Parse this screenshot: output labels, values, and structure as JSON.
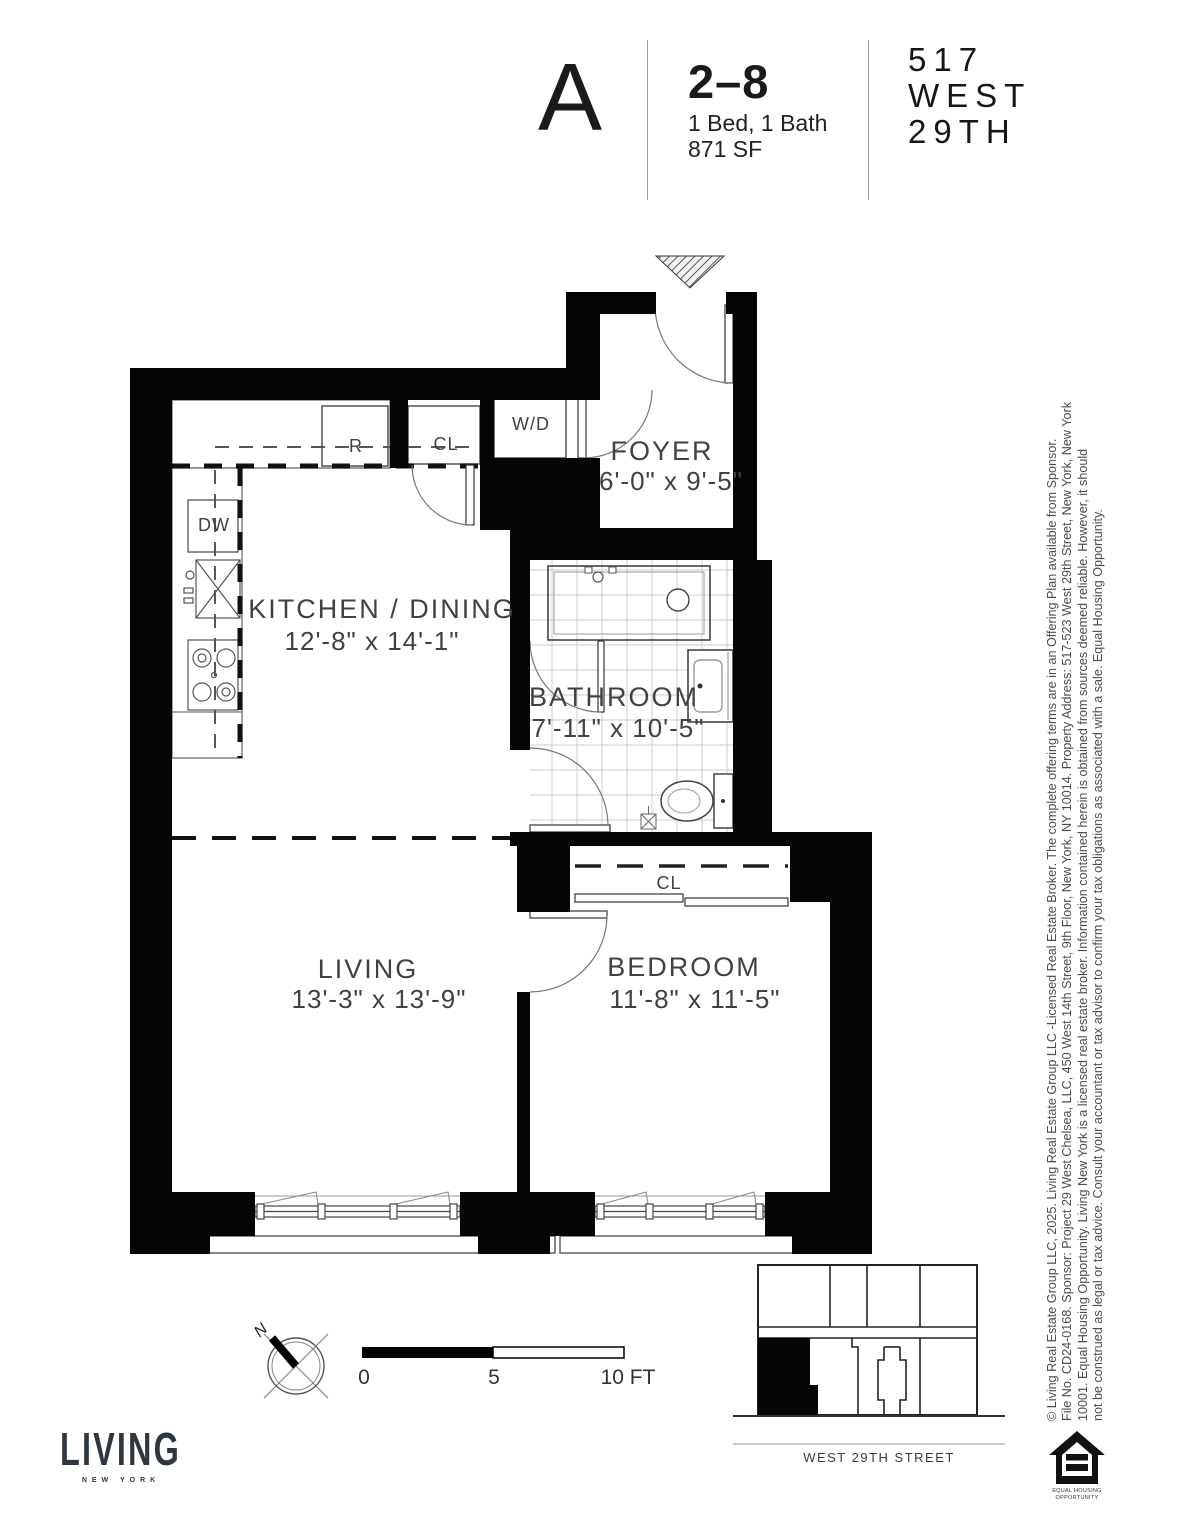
{
  "header": {
    "unit": "A",
    "floors": "2–8",
    "config": "1 Bed, 1 Bath",
    "area": "871 SF",
    "building": {
      "line1": "517",
      "line2": "WEST",
      "line3": "29TH"
    }
  },
  "rooms": {
    "foyer": {
      "name": "FOYER",
      "dims": "6'-0\" x 9'-5\""
    },
    "kitchen": {
      "name": "KITCHEN / DINING",
      "dims": "12'-8\" x 14'-1\""
    },
    "bathroom": {
      "name": "BATHROOM",
      "dims": "7'-11\" x 10'-5\""
    },
    "living": {
      "name": "LIVING",
      "dims": "13'-3\" x 13'-9\""
    },
    "bedroom": {
      "name": "BEDROOM",
      "dims": "11'-8\" x 11'-5\""
    }
  },
  "fixtures": {
    "washer_dryer": "W/D",
    "refrigerator": "R",
    "kitchen_closet": "CL",
    "dishwasher": "DW",
    "bedroom_closet": "CL"
  },
  "compass": {
    "north": "N"
  },
  "scale_bar": {
    "zero": "0",
    "five": "5",
    "ten": "10 FT"
  },
  "key_plan": {
    "street": "WEST 29TH STREET"
  },
  "logo": {
    "brand": "LIVING",
    "sub": "NEW YORK"
  },
  "equal_housing": {
    "line1": "EQUAL HOUSING",
    "line2": "OPPORTUNITY"
  },
  "disclaimer": {
    "line1": "© Living Real Estate Group LLC, 2025. Living Real Estate Group LLC -Licensed Real Estate Broker. The complete offering terms are in an Offering Plan available from Sponsor.",
    "line2": "File No. CD24-0168. Sponsor: Project 29 West Chelsea, LLC, 450 West 14th Street, 9th Floor, New York, NY 10014. Property Address: 517-523 West 29th Street, New York, New York",
    "line3": "10001. Equal Housing Opportunity. Living New York is a licensed real estate broker. Information contained herein is obtained from sources deemed reliable. However, it should",
    "line4": "not be construed as legal or tax advice. Consult your accountant or tax advisor to confirm your tax obligations as associated with a sale. Equal Housing Opportunity."
  },
  "colors": {
    "wall": "#050505",
    "label": "#414141",
    "logo": "#2e3640",
    "tile_line": "#cccccc",
    "disclaimer_text": "#4c4c4c"
  }
}
